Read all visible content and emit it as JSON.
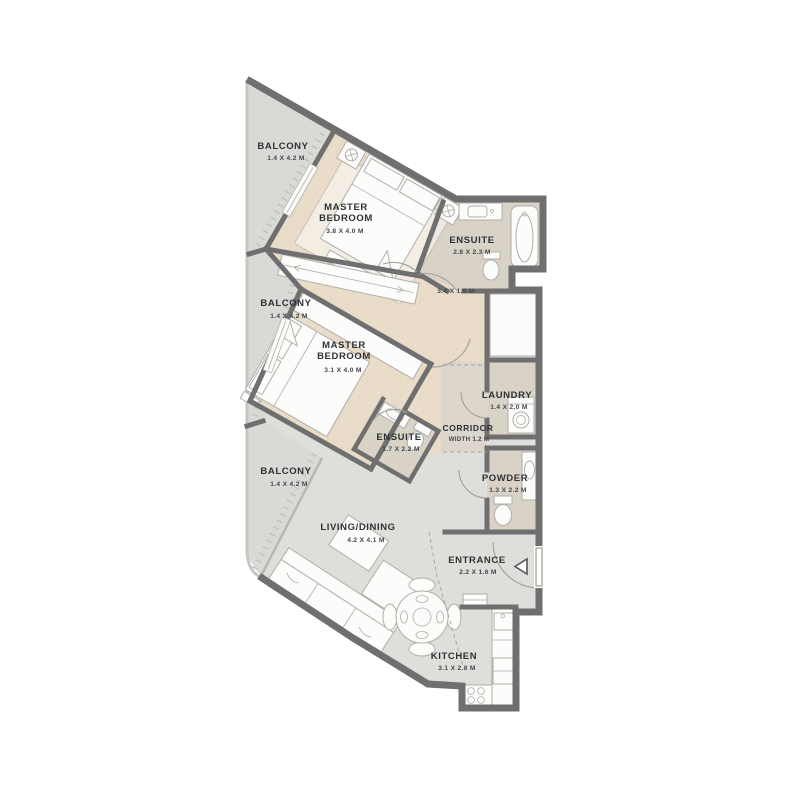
{
  "rooms": [
    {
      "id": "balcony-top",
      "label_lines": [
        "BALCONY"
      ],
      "dims": "1.4 X 4.2 M"
    },
    {
      "id": "master-bedroom-1",
      "label_lines": [
        "MASTER",
        "BEDROOM"
      ],
      "dims": "3.8 X 4.0 M"
    },
    {
      "id": "ensuite-1",
      "label_lines": [
        "ENSUITE"
      ],
      "dims": "2.8 X 2.3 M"
    },
    {
      "id": "balcony-middle",
      "label_lines": [
        "BALCONY"
      ],
      "dims": "1.4 X 4.2 M"
    },
    {
      "id": "hall",
      "label_lines": [],
      "dims": "3.4 X 1.9 M"
    },
    {
      "id": "master-bedroom-2",
      "label_lines": [
        "MASTER",
        "BEDROOM"
      ],
      "dims": "3.1 X 4.0 M"
    },
    {
      "id": "laundry",
      "label_lines": [
        "LAUNDRY"
      ],
      "dims": "1.4 X 2.0 M"
    },
    {
      "id": "ensuite-2",
      "label_lines": [
        "ENSUITE"
      ],
      "dims": "1.7 X 2.2 M"
    },
    {
      "id": "corridor",
      "label_lines": [
        "CORRIDOR"
      ],
      "dims": "WIDTH 1.2 M"
    },
    {
      "id": "balcony-bottom",
      "label_lines": [
        "BALCONY"
      ],
      "dims": "1.4 X 4.2 M"
    },
    {
      "id": "powder",
      "label_lines": [
        "POWDER"
      ],
      "dims": "1.3 X 2.2 M"
    },
    {
      "id": "living-dining",
      "label_lines": [
        "LIVING/DINING"
      ],
      "dims": "4.2 X 4.1 M"
    },
    {
      "id": "entrance",
      "label_lines": [
        "ENTRANCE"
      ],
      "dims": "2.2 X 1.6 M"
    },
    {
      "id": "kitchen",
      "label_lines": [
        "KITCHEN"
      ],
      "dims": "3.1 X 2.8 M"
    }
  ],
  "colors": {
    "wall": "#6f6f6f",
    "wood_floor": "#e9dcc9",
    "tile_floor": "#d9d2c6",
    "balcony_floor": "#d9d9d6",
    "main_floor": "#dededa",
    "label_text": "#2e3236",
    "background": "#ffffff"
  }
}
